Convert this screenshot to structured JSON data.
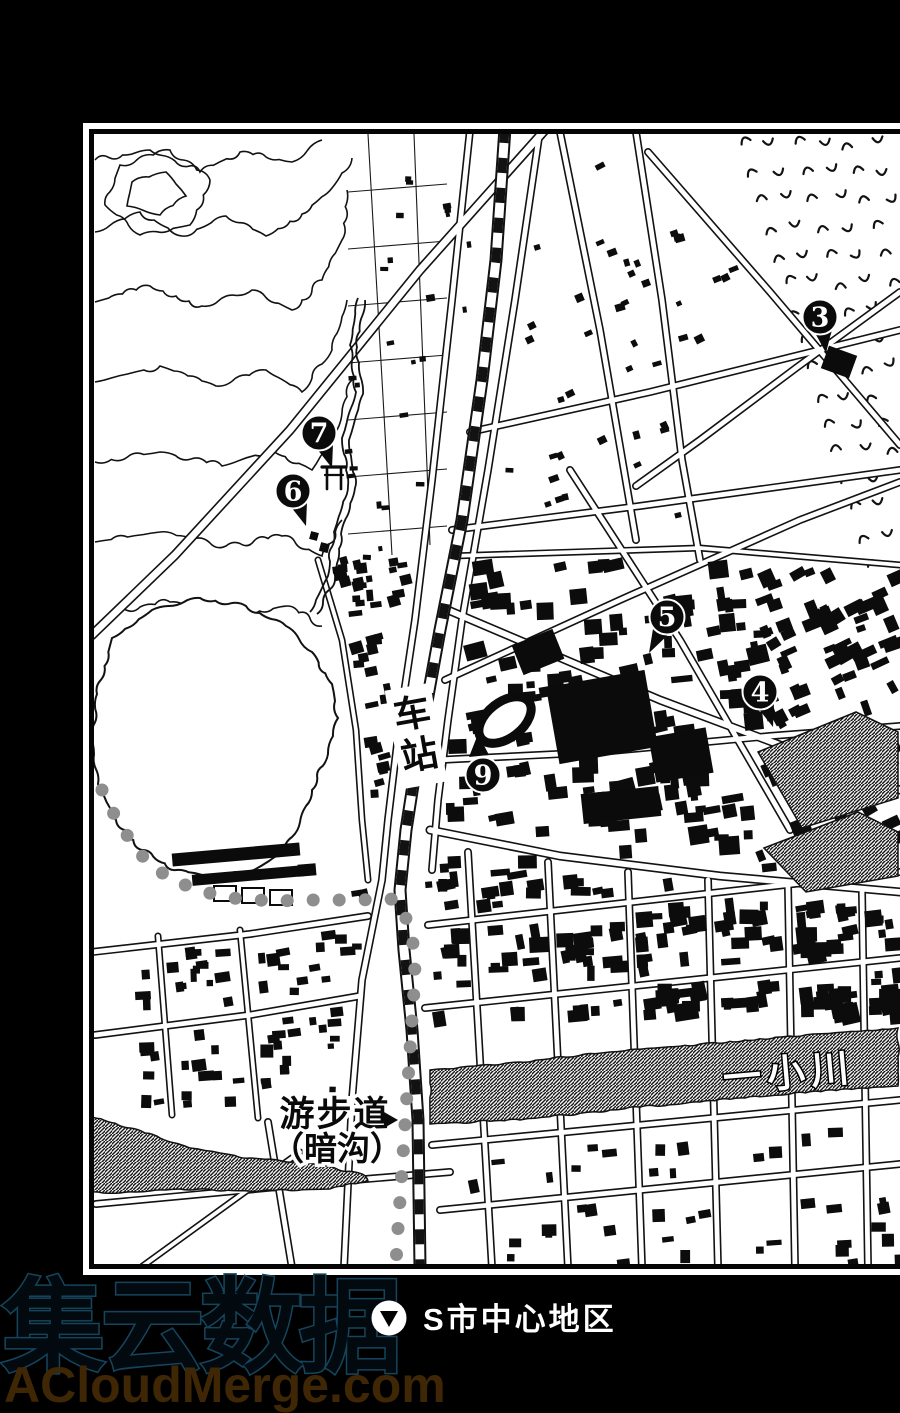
{
  "page_caption": {
    "icon": "location-down-triangle",
    "text": "S市中心地区"
  },
  "map": {
    "labels": {
      "station": "车站",
      "station_char_1": "车",
      "station_char_2": "站",
      "promenade_line_1": "游步道",
      "promenade_line_2": "（暗沟）",
      "river": "一小川"
    },
    "markers": [
      {
        "number": "3",
        "x": 820,
        "y": 317,
        "pointer": "down"
      },
      {
        "number": "4",
        "x": 760,
        "y": 692,
        "pointer": "down-right"
      },
      {
        "number": "5",
        "x": 667,
        "y": 617,
        "pointer": "down-left"
      },
      {
        "number": "6",
        "x": 293,
        "y": 491,
        "pointer": "down-right"
      },
      {
        "number": "7",
        "x": 319,
        "y": 433,
        "pointer": "down-right"
      },
      {
        "number": "9",
        "x": 483,
        "y": 775,
        "pointer": "up"
      }
    ],
    "symbols": [
      {
        "name": "torii-shrine",
        "x": 334,
        "y": 477
      }
    ]
  },
  "watermark": {
    "line_1": "集云数据",
    "line_2": "ACloudMerge.com",
    "color_line_1": "#15455c",
    "color_line_2": "#3f2706"
  },
  "colors": {
    "page_background": "#000000",
    "map_background": "#ffffff",
    "ink": "#111111",
    "promenade_dots": "#8e8e8e"
  }
}
